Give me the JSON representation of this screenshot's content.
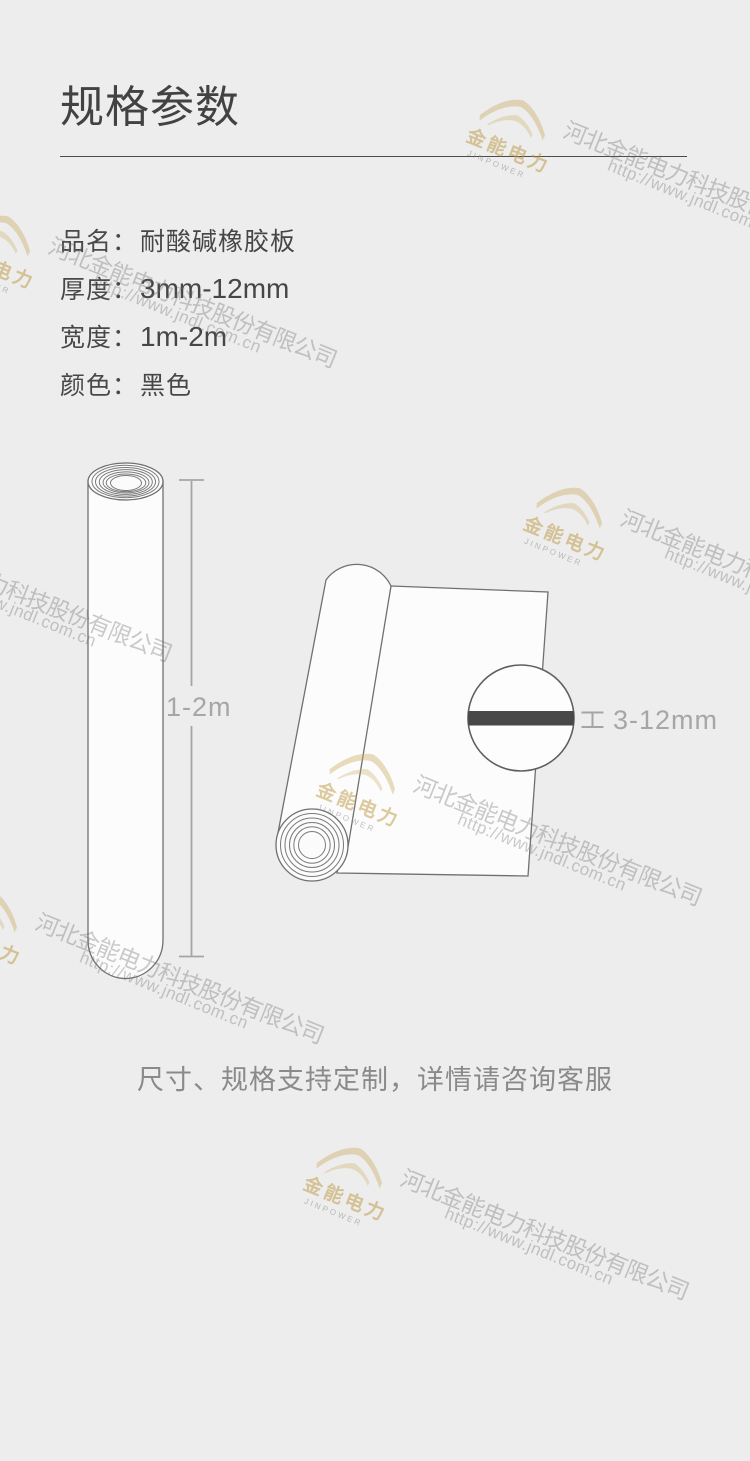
{
  "meta": {
    "background_color": "#ededed",
    "accent_gold": "#cdaa5a",
    "text_primary": "#464646",
    "text_dim": "#a6a6a6",
    "sheet_bar_color": "#484848"
  },
  "header": {
    "title": "规格参数"
  },
  "specs": [
    {
      "label": "品名：",
      "value": "耐酸碱橡胶板"
    },
    {
      "label": "厚度：",
      "value": "3mm-12mm"
    },
    {
      "label": "宽度：",
      "value": "1m-2m"
    },
    {
      "label": "颜色：",
      "value": "黑色"
    }
  ],
  "diagram": {
    "length_label": "1-2m",
    "thickness_label": "3-12mm"
  },
  "footer": {
    "note": "尺寸、规格支持定制，详情请咨询客服"
  },
  "watermark": {
    "logo_text": "金能电力",
    "logo_subtext": "JINPOWER",
    "company": "河北金能电力科技股份有限公司",
    "url": "http://www.jndl.com.cn"
  }
}
